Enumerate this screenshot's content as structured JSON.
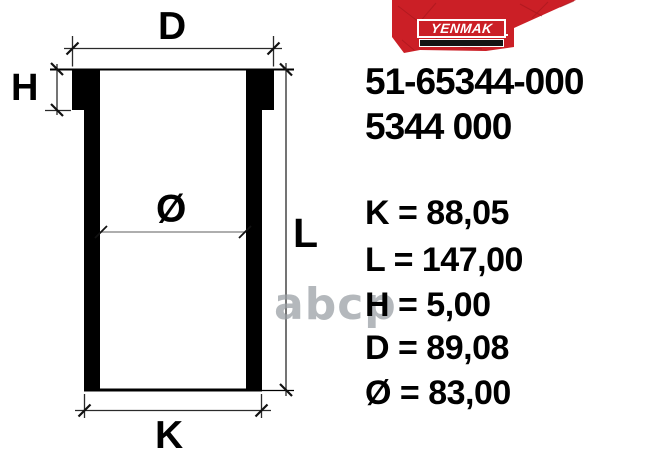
{
  "brand": {
    "name": "YENMAK"
  },
  "part_numbers": {
    "primary": "51-65344-000",
    "secondary": "5344 000"
  },
  "diagram_labels": {
    "flange_diameter": "D",
    "flange_height": "H",
    "bore_diameter": "Ø",
    "length": "L",
    "body_diameter": "K"
  },
  "specs": [
    {
      "label": "K",
      "value": "88,05",
      "display": "K = 88,05"
    },
    {
      "label": "L",
      "value": "147,00",
      "display": "L = 147,00"
    },
    {
      "label": "H",
      "value": "5,00",
      "display": "H = 5,00"
    },
    {
      "label": "D",
      "value": "89,08",
      "display": "D = 89,08"
    },
    {
      "label": "Ø",
      "value": "83,00",
      "display": "Ø = 83,00"
    }
  ],
  "watermark": "abcp",
  "colors": {
    "banner_red": "#cb1f26",
    "crack_red": "#9e151b",
    "text_black": "#000000",
    "watermark_gray": "#989ea3"
  }
}
